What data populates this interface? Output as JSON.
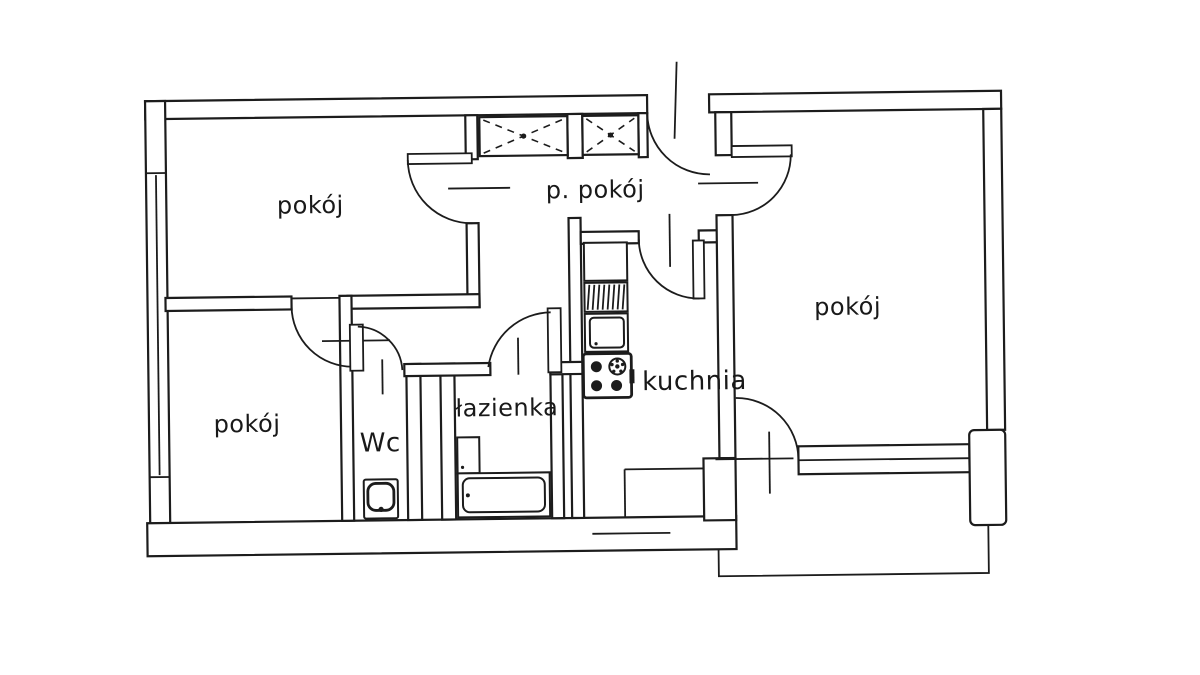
{
  "colors": {
    "background": "#ffffff",
    "line": "#1c1c1c",
    "label_text": "#191919"
  },
  "rooms": {
    "room_top_left": {
      "label": "pokój"
    },
    "hallway": {
      "label": "p. pokój"
    },
    "room_right": {
      "label": "pokój"
    },
    "room_bottom_left": {
      "label": "pokój"
    },
    "wc": {
      "label": "Wc"
    },
    "bathroom": {
      "label": "łazienka"
    },
    "kitchen": {
      "label": "kuchnia"
    }
  },
  "fixtures": [
    "wardrobe",
    "wardrobe",
    "entrance-door",
    "kitchen-counter",
    "kitchen-drainer",
    "kitchen-sink",
    "stove",
    "bathtub",
    "washbasin",
    "toilet",
    "window",
    "balcony"
  ]
}
